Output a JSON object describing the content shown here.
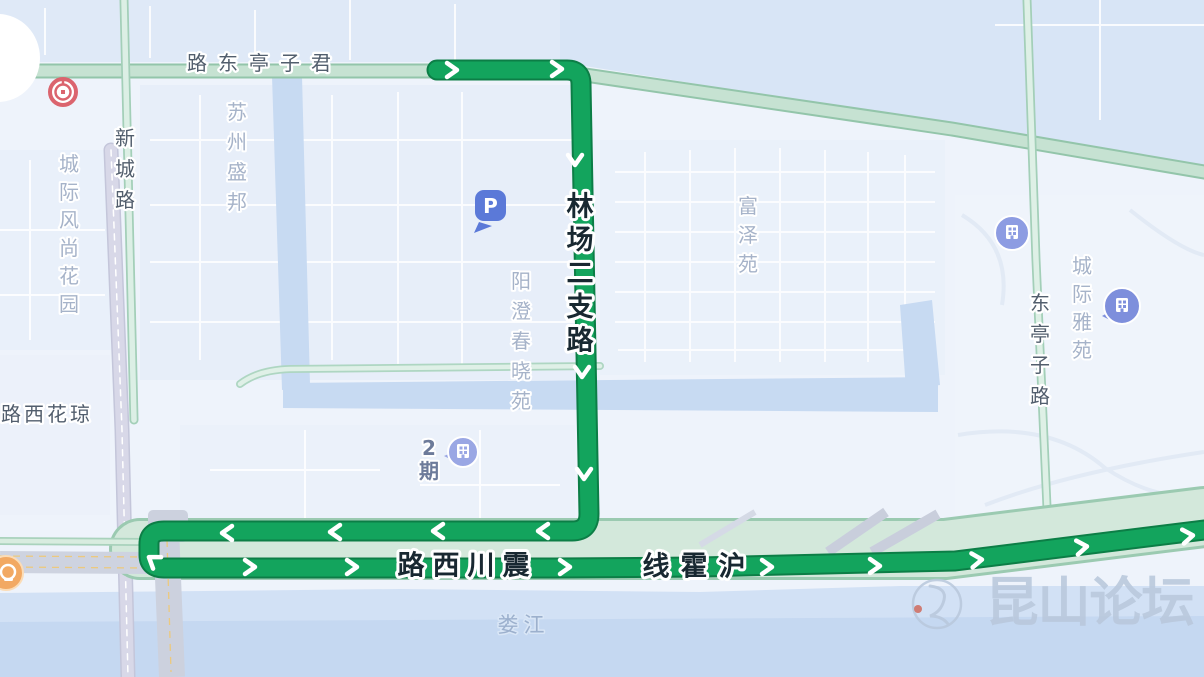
{
  "app": {
    "type": "map-view",
    "description": "bus route on city map"
  },
  "colors": {
    "route_green": "#13a45d",
    "route_border": "#0c7e46",
    "road_teal_fill": "#cfe6d8",
    "road_teal_edge": "#98c7ae",
    "water": "#c9dbf2",
    "land": "#eef3fb",
    "watermark": "#b9c8dc",
    "parking_pin": "#5b79d8",
    "building_pin": "#8d9ce2",
    "bank_icon_red": "#db646e",
    "orange_poi": "#f2a963"
  },
  "route": {
    "road_names_on_route": [
      "林场二支路",
      "震川西路",
      "沪霍线"
    ],
    "direction_arrows": "white chevrons along route"
  },
  "poi": {
    "parking_label": "P"
  },
  "watermark": {
    "text": "昆山论坛"
  },
  "labels": [
    {
      "id": "route-label-linchangerzhilu",
      "text": "林场二支路",
      "cls": "route-label",
      "dir": "v",
      "x": 580,
      "y": 207,
      "spacing": 33.5
    },
    {
      "id": "route-label-zhenchuanxilu",
      "text": "震川西路",
      "cls": "route-label",
      "dir": "rtl",
      "x": 516,
      "y": 566,
      "spacing": 35
    },
    {
      "id": "route-label-huhuoxian",
      "text": "沪霍线",
      "cls": "route-label",
      "dir": "rtl",
      "x": 732,
      "y": 567,
      "spacing": 38
    },
    {
      "id": "road-label-junzitingdonglu",
      "text": "君子亭东路",
      "cls": "road-label",
      "dir": "rtl",
      "x": 321,
      "y": 63,
      "spacing": 31
    },
    {
      "id": "road-label-xinchenglu",
      "text": "新城路",
      "cls": "road-label",
      "dir": "v",
      "x": 125,
      "y": 138,
      "spacing": 31
    },
    {
      "id": "road-label-dongtingzilu",
      "text": "东亭子路",
      "cls": "road-label",
      "dir": "v",
      "x": 1040,
      "y": 303,
      "spacing": 31
    },
    {
      "id": "road-label-qionghuaxilu",
      "text": "琼花西路",
      "cls": "road-label",
      "dir": "rtl",
      "x": 80,
      "y": 414,
      "spacing": 23
    },
    {
      "id": "area-label-suzhoushengbang",
      "text": "苏州盛邦",
      "cls": "area-label",
      "dir": "v",
      "x": 237,
      "y": 112,
      "spacing": 30
    },
    {
      "id": "area-label-chengjifengshanghuayuan",
      "text": "城际风尚花园",
      "cls": "area-label",
      "dir": "v",
      "x": 69,
      "y": 164,
      "spacing": 28
    },
    {
      "id": "area-label-yangchengchunxiaoyuan",
      "text": "阳澄春晓苑",
      "cls": "area-label",
      "dir": "v",
      "x": 521,
      "y": 281,
      "spacing": 30
    },
    {
      "id": "area-label-fuzeyuan",
      "text": "富泽苑",
      "cls": "area-label",
      "dir": "v",
      "x": 748,
      "y": 206,
      "spacing": 29
    },
    {
      "id": "area-label-chengjiyayuan",
      "text": "城际雅苑",
      "cls": "area-label",
      "dir": "v",
      "x": 1082,
      "y": 266,
      "spacing": 28
    },
    {
      "id": "poi-label-erqi",
      "text": "2期",
      "cls": "poi-label",
      "dir": "v",
      "x": 429,
      "y": 448,
      "spacing": 23
    },
    {
      "id": "water-label-loujiang",
      "text": "娄江",
      "cls": "water-label",
      "dir": "h",
      "x": 508,
      "y": 625,
      "spacing": 26
    },
    {
      "id": "watermark-text",
      "text": "昆山论坛",
      "cls": "watermark-text",
      "dir": "h",
      "x": 1012,
      "y": 603,
      "spacing": 52
    }
  ]
}
